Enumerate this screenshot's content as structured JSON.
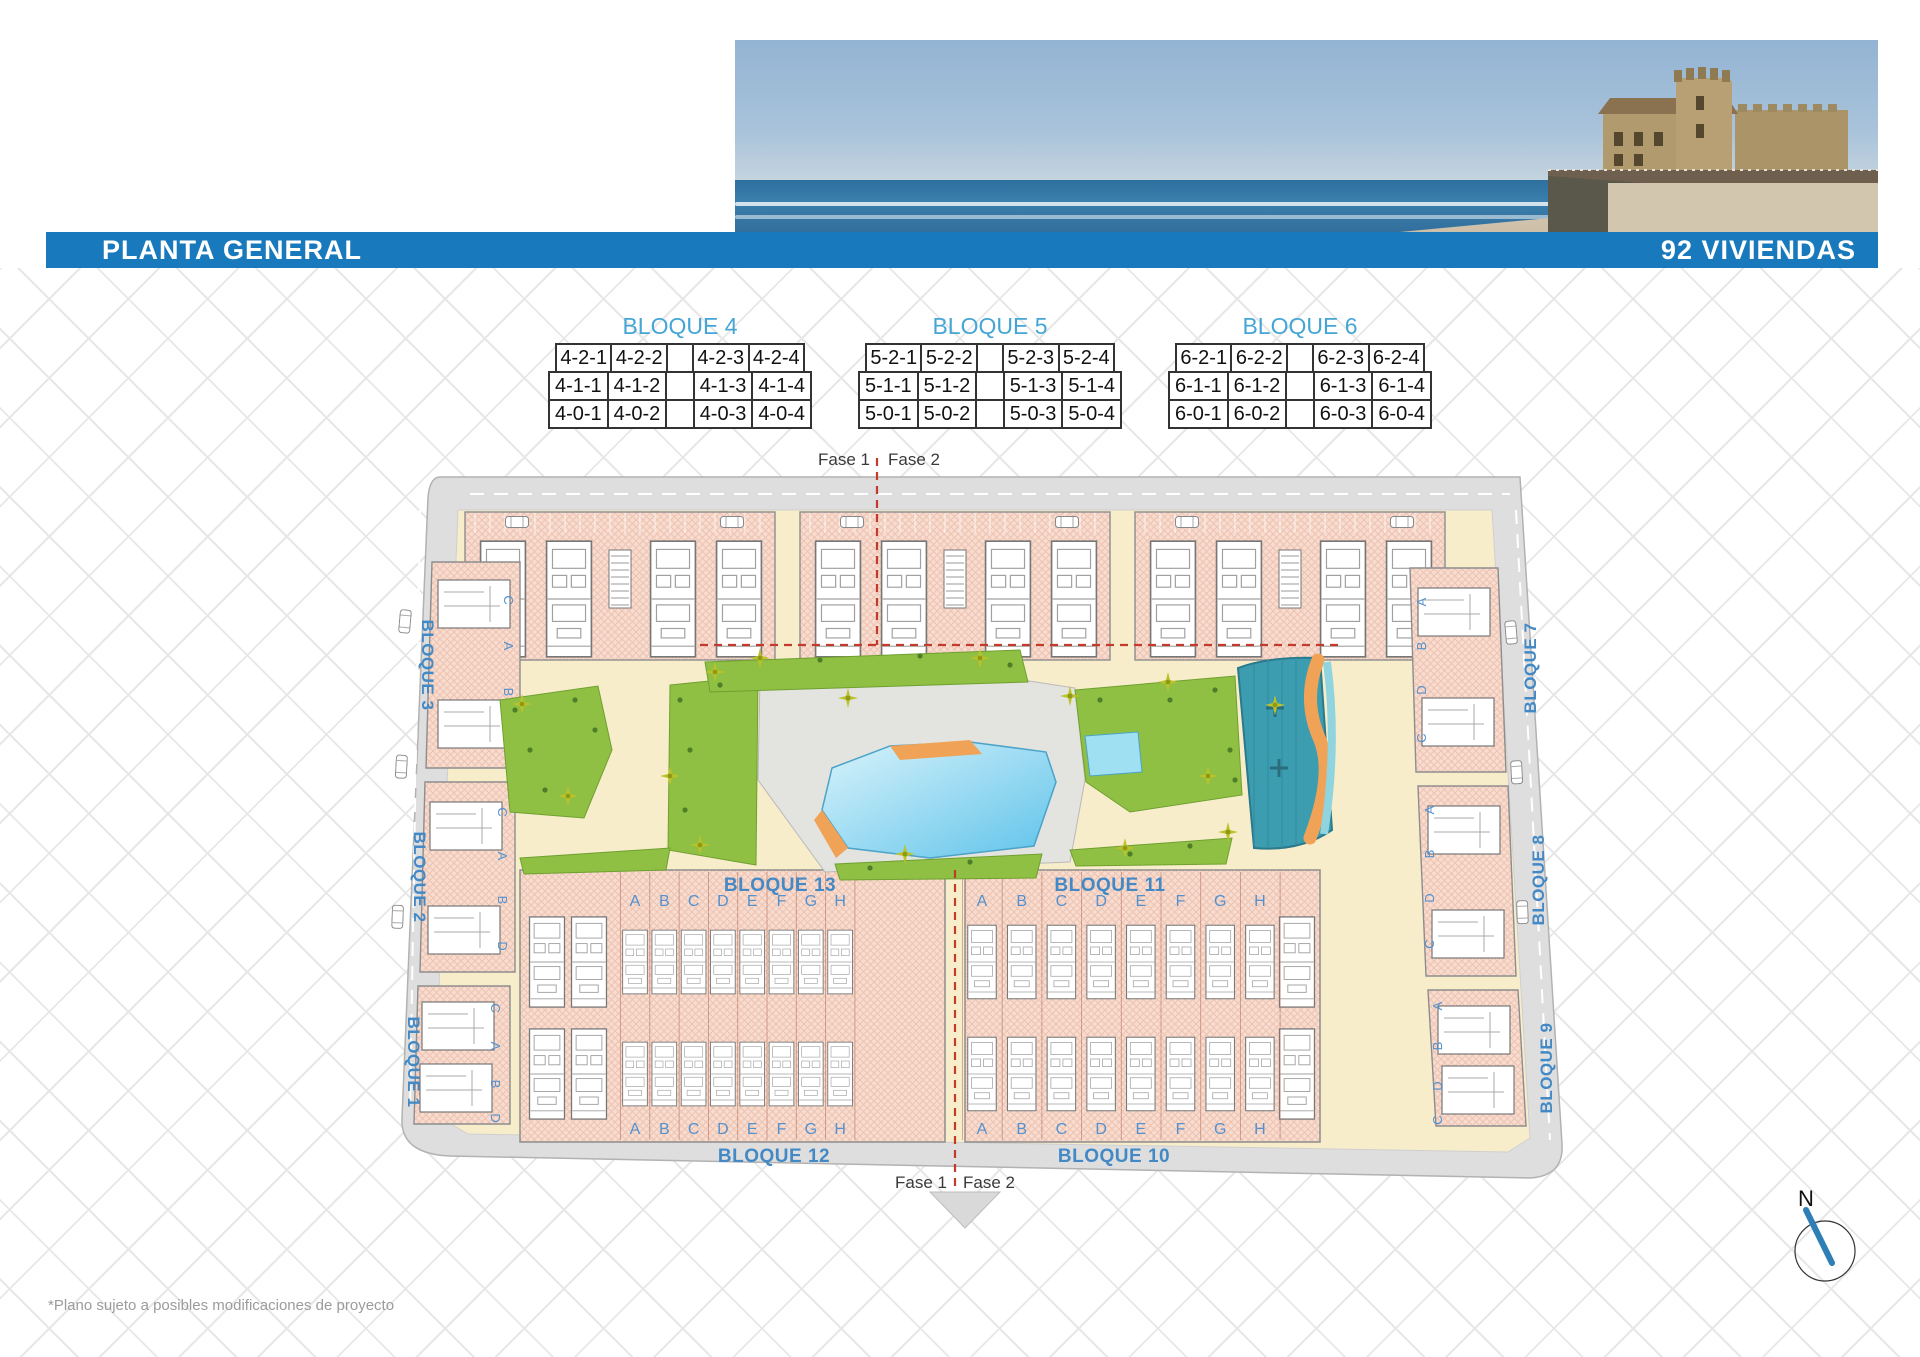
{
  "header": {
    "title": "PLANTA GENERAL",
    "subtitle": "92 VIVIENDAS"
  },
  "legend_tables": [
    {
      "title": "BLOQUE 4",
      "rows": [
        [
          "4-2-1",
          "4-2-2",
          "",
          "4-2-3",
          "4-2-4"
        ],
        [
          "4-1-1",
          "4-1-2",
          "",
          "4-1-3",
          "4-1-4"
        ],
        [
          "4-0-1",
          "4-0-2",
          "",
          "4-0-3",
          "4-0-4"
        ]
      ]
    },
    {
      "title": "BLOQUE 5",
      "rows": [
        [
          "5-2-1",
          "5-2-2",
          "",
          "5-2-3",
          "5-2-4"
        ],
        [
          "5-1-1",
          "5-1-2",
          "",
          "5-1-3",
          "5-1-4"
        ],
        [
          "5-0-1",
          "5-0-2",
          "",
          "5-0-3",
          "5-0-4"
        ]
      ]
    },
    {
      "title": "BLOQUE 6",
      "rows": [
        [
          "6-2-1",
          "6-2-2",
          "",
          "6-2-3",
          "6-2-4"
        ],
        [
          "6-1-1",
          "6-1-2",
          "",
          "6-1-3",
          "6-1-4"
        ],
        [
          "6-0-1",
          "6-0-2",
          "",
          "6-0-3",
          "6-0-4"
        ]
      ]
    }
  ],
  "phase": {
    "fase1": "Fase 1",
    "fase2": "Fase 2"
  },
  "site_plan": {
    "left_blocks": [
      "BLOQUE 3",
      "BLOQUE 2",
      "BLOQUE 1"
    ],
    "right_blocks": [
      "BLOQUE 7",
      "BLOQUE 8",
      "BLOQUE 9"
    ],
    "row_blocks": {
      "upper_left": "BLOQUE 13",
      "upper_right": "BLOQUE 11",
      "lower_left": "BLOQUE 12",
      "lower_right": "BLOQUE 10"
    },
    "unit_letters": [
      "A",
      "B",
      "C",
      "D",
      "E",
      "F",
      "G",
      "H"
    ],
    "side_letters_left": [
      "C",
      "A",
      "B",
      "D"
    ],
    "side_letters_right": [
      "A",
      "B",
      "D",
      "C"
    ]
  },
  "compass": {
    "north_label": "N"
  },
  "footnote": "*Plano sujeto a posibles modificaciones de proyecto",
  "colors": {
    "header_bar": "#1879bc",
    "table_title_blue": "#45a6d6",
    "plan_label_blue": "#4389c6",
    "building_pink": "#f7dccf",
    "ground_cream": "#f8edcb",
    "road_gray": "#dedede",
    "green": "#8fc043",
    "pool_blue": "#5fc3ea",
    "splash_teal": "#3d9db0",
    "river_orange": "#f0a357",
    "phase_red": "#c23b2c"
  }
}
